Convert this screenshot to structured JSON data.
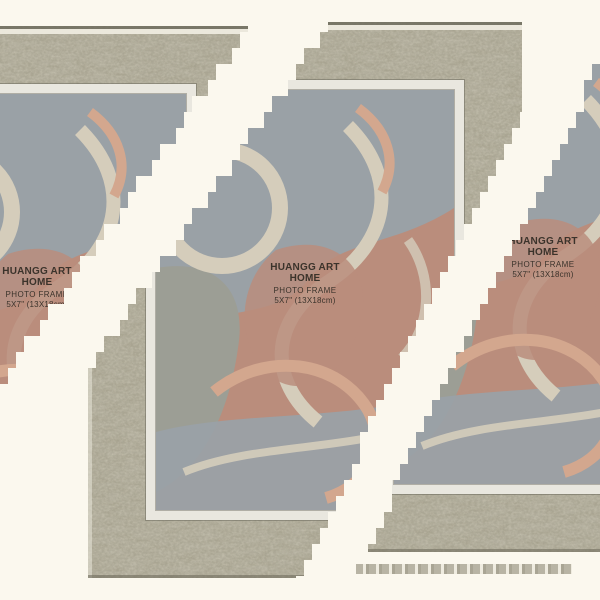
{
  "image": {
    "description": "Glitched product photo of a rustic grey wood photo frame with abstract swirl insert, split into three diagonal strips by white corruption bands",
    "orientation": "portrait frame on white background"
  },
  "label": {
    "brand": "HUANGG ART HOME",
    "product": "PHOTO FRAME",
    "size": "5X7\" (13X18cm)"
  },
  "colors": {
    "background": "#fbf8ee",
    "moulding_base": "#b1ad9c",
    "moulding_dark": "#6f6d5e",
    "moulding_light": "#eeebdf",
    "liner": "#e9e7df",
    "art_clay": "#ba8d7c",
    "art_grey_blue": "#9aa1a6",
    "art_sage": "#9c9e95",
    "art_cream": "#d5cdbb",
    "art_salmon": "#d3a78e",
    "text": "#3b332b"
  }
}
